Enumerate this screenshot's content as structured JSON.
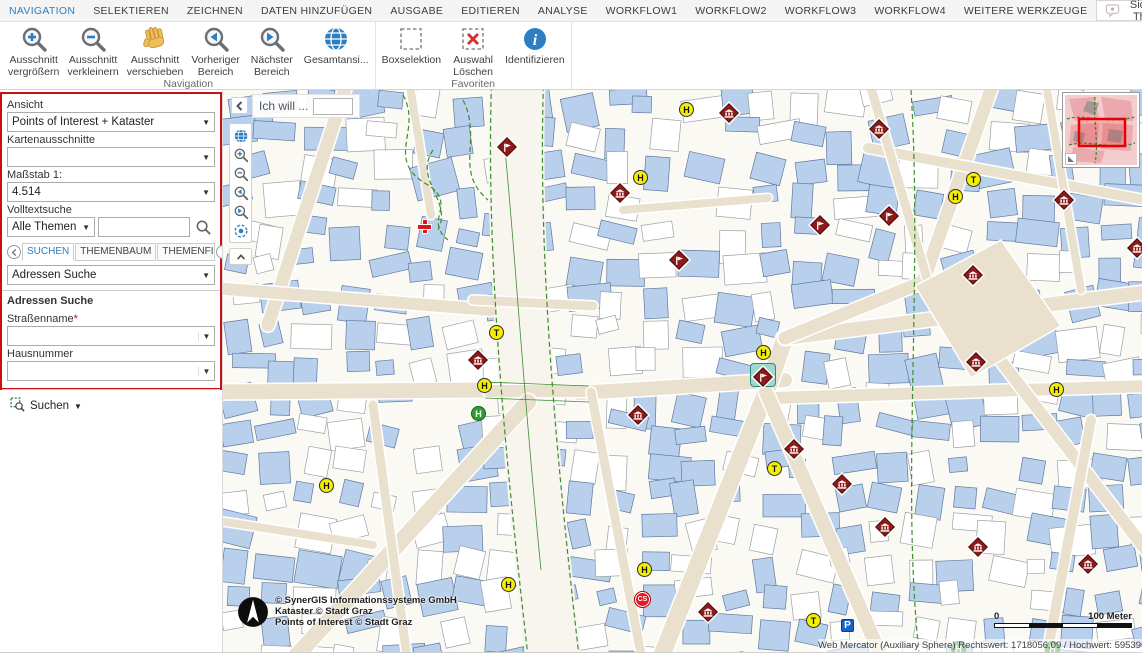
{
  "menu": {
    "items": [
      {
        "label": "NAVIGATION",
        "active": true
      },
      {
        "label": "SELEKTIEREN",
        "active": false
      },
      {
        "label": "ZEICHNEN",
        "active": false
      },
      {
        "label": "DATEN HINZUFÜGEN",
        "active": false
      },
      {
        "label": "AUSGABE",
        "active": false
      },
      {
        "label": "EDITIEREN",
        "active": false
      },
      {
        "label": "ANALYSE",
        "active": false
      },
      {
        "label": "WORKFLOW1",
        "active": false
      },
      {
        "label": "WORKFLOW2",
        "active": false
      },
      {
        "label": "WORKFLOW3",
        "active": false
      },
      {
        "label": "WORKFLOW4",
        "active": false
      },
      {
        "label": "WEITERE WERKZEUGE",
        "active": false
      }
    ],
    "visible_themes": "Sichtbare Themen",
    "right_icons": [
      "comment-bubble",
      "flag-uk",
      "flag-germany",
      "flag-uae",
      "flag-crescent",
      "help",
      "link",
      "save",
      "gear",
      "collapse-up"
    ]
  },
  "ribbon": {
    "groups": [
      {
        "label": "Navigation",
        "buttons": [
          {
            "label": [
              "Ausschnitt",
              "vergrößern"
            ],
            "icon": "zoom-in"
          },
          {
            "label": [
              "Ausschnitt",
              "verkleinern"
            ],
            "icon": "zoom-out"
          },
          {
            "label": [
              "Ausschnitt",
              "verschieben"
            ],
            "icon": "pan-hand"
          },
          {
            "label": [
              "Vorheriger",
              "Bereich"
            ],
            "icon": "prev-extent"
          },
          {
            "label": [
              "Nächster",
              "Bereich"
            ],
            "icon": "next-extent"
          },
          {
            "label": [
              "Gesamtansi...",
              ""
            ],
            "icon": "full-extent"
          }
        ]
      },
      {
        "label": "Favoriten",
        "buttons": [
          {
            "label": [
              "Boxselektion",
              ""
            ],
            "icon": "box-select"
          },
          {
            "label": [
              "Auswahl",
              "Löschen"
            ],
            "icon": "clear-selection"
          },
          {
            "label": [
              "Identifizieren",
              ""
            ],
            "icon": "identify"
          }
        ]
      }
    ]
  },
  "panel": {
    "ansicht_label": "Ansicht",
    "ansicht_value": "Points of Interest + Kataster",
    "kartenausschnitte_label": "Kartenausschnitte",
    "kartenausschnitte_value": "",
    "massstab_label": "Maßstab 1:",
    "massstab_value": "4.514",
    "volltext_label": "Volltextsuche",
    "themen_value": "Alle Themen",
    "tabs": {
      "labels": [
        "SUCHEN",
        "THEMENBAUM",
        "THEMENFILTER"
      ],
      "active": 0
    },
    "adressen_select": "Adressen Suche",
    "section_title": "Adressen Suche",
    "strassenname_label": "Straßenname",
    "required_mark": "*",
    "hausnummer_label": "Hausnummer",
    "suchen_label": "Suchen"
  },
  "map": {
    "ich_will": "Ich will ...",
    "copyright": [
      "© SynerGIS Informationssysteme GmbH",
      "Kataster © Stadt Graz",
      "Points of Interest © Stadt Graz"
    ],
    "scale_zero": "0",
    "scale_label": "100 Meter",
    "status": "Web Mercator (Auxiliary Sphere) Rechtswert: 1718056,09 / Hochwert: 5953969,73",
    "markers": [
      {
        "t": "circle",
        "c": "yellow",
        "l": "H",
        "x": 456,
        "y": 12
      },
      {
        "t": "museum",
        "x": 499,
        "y": 16
      },
      {
        "t": "museum",
        "x": 649,
        "y": 32
      },
      {
        "t": "flag",
        "x": 277,
        "y": 50
      },
      {
        "t": "circle",
        "c": "yellow",
        "l": "H",
        "x": 410,
        "y": 80
      },
      {
        "t": "museum",
        "x": 390,
        "y": 96
      },
      {
        "t": "circle",
        "c": "yellow",
        "l": "T",
        "x": 743,
        "y": 82
      },
      {
        "t": "circle",
        "c": "yellow",
        "l": "H",
        "x": 725,
        "y": 99
      },
      {
        "t": "museum",
        "x": 834,
        "y": 103
      },
      {
        "t": "flag",
        "x": 659,
        "y": 119
      },
      {
        "t": "flag",
        "x": 590,
        "y": 128
      },
      {
        "t": "cross",
        "x": 195,
        "y": 130
      },
      {
        "t": "museum",
        "x": 907,
        "y": 151
      },
      {
        "t": "flag",
        "x": 449,
        "y": 163
      },
      {
        "t": "museum",
        "x": 743,
        "y": 178
      },
      {
        "t": "circle",
        "c": "yellow",
        "l": "T",
        "x": 266,
        "y": 235
      },
      {
        "t": "museum",
        "x": 248,
        "y": 263
      },
      {
        "t": "museum",
        "x": 746,
        "y": 265
      },
      {
        "t": "circle",
        "c": "yellow",
        "l": "H",
        "x": 533,
        "y": 255
      },
      {
        "t": "flag-green",
        "x": 533,
        "y": 280
      },
      {
        "t": "circle",
        "c": "yellow",
        "l": "H",
        "x": 254,
        "y": 288
      },
      {
        "t": "circle",
        "c": "yellow",
        "l": "H",
        "x": 826,
        "y": 292
      },
      {
        "t": "circle",
        "c": "green",
        "l": "H",
        "x": 248,
        "y": 316
      },
      {
        "t": "museum",
        "x": 408,
        "y": 318
      },
      {
        "t": "museum",
        "x": 564,
        "y": 352
      },
      {
        "t": "circle",
        "c": "yellow",
        "l": "T",
        "x": 544,
        "y": 371
      },
      {
        "t": "museum",
        "x": 612,
        "y": 387
      },
      {
        "t": "circle",
        "c": "yellow",
        "l": "H",
        "x": 96,
        "y": 388
      },
      {
        "t": "museum",
        "x": 655,
        "y": 430
      },
      {
        "t": "museum",
        "x": 748,
        "y": 450
      },
      {
        "t": "museum",
        "x": 858,
        "y": 467
      },
      {
        "t": "circle",
        "c": "yellow",
        "l": "H",
        "x": 414,
        "y": 472
      },
      {
        "t": "circle",
        "c": "yellow",
        "l": "H",
        "x": 278,
        "y": 487
      },
      {
        "t": "circle",
        "c": "red",
        "l": "CS",
        "x": 412,
        "y": 502
      },
      {
        "t": "museum",
        "x": 478,
        "y": 515
      },
      {
        "t": "circle",
        "c": "yellow",
        "l": "T",
        "x": 583,
        "y": 523
      },
      {
        "t": "square",
        "c": "blue",
        "l": "P",
        "x": 618,
        "y": 529
      },
      {
        "t": "circle",
        "c": "green",
        "l": "H",
        "x": 728,
        "y": 551
      },
      {
        "t": "circle",
        "c": "green",
        "l": "H",
        "x": 822,
        "y": 551
      }
    ]
  },
  "colors": {
    "accent": "#2d7fc1",
    "panel_border": "#cf0e0e",
    "marker_red": "#8e1a1a",
    "marker_yellow": "#f5ee00",
    "marker_green": "#2f9e33",
    "building": "#b9d0ed",
    "street": "#e9e1cd",
    "green_line": "#3f8c33"
  }
}
